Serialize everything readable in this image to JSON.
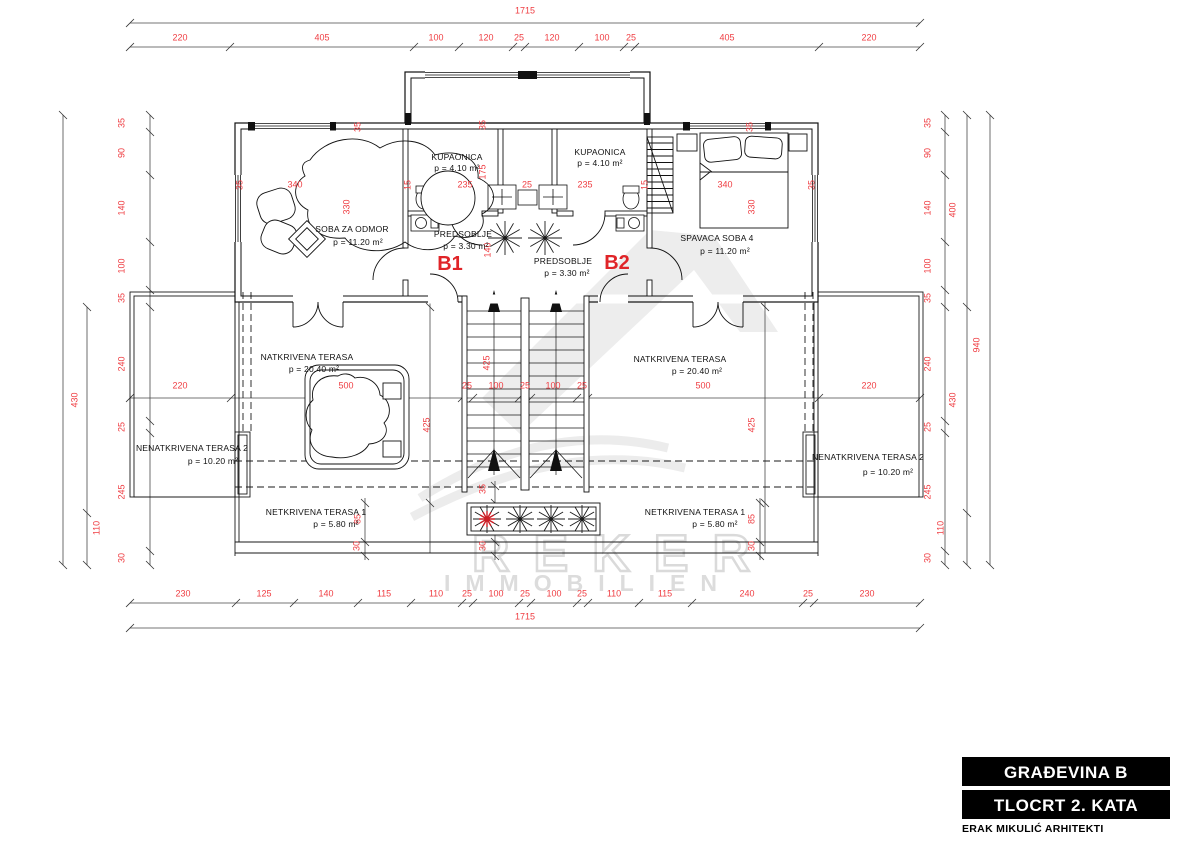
{
  "title_block": {
    "line1": "GRAĐEVINA B",
    "line2": "TLOCRT 2. KATA",
    "line3": "ERAK MIKULIĆ ARHITEKTI"
  },
  "watermark": {
    "word1": "REKER",
    "word2": "IMMOBILIEN"
  },
  "colors": {
    "dimension_red": "#ef3d42",
    "unit_red": "#e02428",
    "line_black": "#1a1a1a",
    "watermark_gray": "#dcdcdc"
  },
  "unit_labels": [
    {
      "t": "B1",
      "x": 450,
      "y": 264
    },
    {
      "t": "B2",
      "x": 617,
      "y": 263
    }
  ],
  "room_labels": [
    {
      "t": "SOBA ZA ODMOR",
      "x": 352,
      "y": 229
    },
    {
      "t": "p = 11.20 m²",
      "x": 358,
      "y": 242
    },
    {
      "t": "KUPAONICA",
      "x": 457,
      "y": 157
    },
    {
      "t": "p = 4.10 m²",
      "x": 457,
      "y": 168
    },
    {
      "t": "KUPAONICA",
      "x": 600,
      "y": 152
    },
    {
      "t": "p = 4.10 m²",
      "x": 600,
      "y": 163
    },
    {
      "t": "PREDSOBLJE",
      "x": 463,
      "y": 234
    },
    {
      "t": "p = 3.30 m²",
      "x": 466,
      "y": 246
    },
    {
      "t": "PREDSOBLJE",
      "x": 563,
      "y": 261
    },
    {
      "t": "p = 3.30 m²",
      "x": 567,
      "y": 273
    },
    {
      "t": "SPAVACA SOBA 4",
      "x": 717,
      "y": 238
    },
    {
      "t": "p = 11.20 m²",
      "x": 725,
      "y": 251
    },
    {
      "t": "NATKRIVENA TERASA",
      "x": 307,
      "y": 357
    },
    {
      "t": "p = 20.40 m²",
      "x": 314,
      "y": 369
    },
    {
      "t": "NATKRIVENA TERASA",
      "x": 680,
      "y": 359
    },
    {
      "t": "p = 20.40 m²",
      "x": 697,
      "y": 371
    },
    {
      "t": "NENATKRIVENA TERASA 2",
      "x": 192,
      "y": 448
    },
    {
      "t": "p = 10.20 m²",
      "x": 213,
      "y": 461
    },
    {
      "t": "NENATKRIVENA TERASA 2",
      "x": 868,
      "y": 457
    },
    {
      "t": "p = 10.20 m²",
      "x": 888,
      "y": 472
    },
    {
      "t": "NETKRIVENA TERASA 1",
      "x": 316,
      "y": 512
    },
    {
      "t": "p = 5.80 m²",
      "x": 336,
      "y": 524
    },
    {
      "t": "NETKRIVENA TERASA 1",
      "x": 695,
      "y": 512
    },
    {
      "t": "p = 5.80 m²",
      "x": 715,
      "y": 524
    }
  ],
  "dimension_labels": [
    {
      "t": "1715",
      "x": 525,
      "y": 11
    },
    {
      "t": "220",
      "x": 180,
      "y": 38
    },
    {
      "t": "405",
      "x": 322,
      "y": 38
    },
    {
      "t": "100",
      "x": 436,
      "y": 38
    },
    {
      "t": "120",
      "x": 486,
      "y": 38
    },
    {
      "t": "25",
      "x": 519,
      "y": 38
    },
    {
      "t": "120",
      "x": 552,
      "y": 38
    },
    {
      "t": "100",
      "x": 602,
      "y": 38
    },
    {
      "t": "25",
      "x": 631,
      "y": 38
    },
    {
      "t": "405",
      "x": 727,
      "y": 38
    },
    {
      "t": "220",
      "x": 869,
      "y": 38
    },
    {
      "t": "230",
      "x": 183,
      "y": 594
    },
    {
      "t": "125",
      "x": 264,
      "y": 594
    },
    {
      "t": "140",
      "x": 326,
      "y": 594
    },
    {
      "t": "115",
      "x": 384,
      "y": 594
    },
    {
      "t": "110",
      "x": 436,
      "y": 594
    },
    {
      "t": "25",
      "x": 467,
      "y": 594
    },
    {
      "t": "100",
      "x": 496,
      "y": 594
    },
    {
      "t": "25",
      "x": 525,
      "y": 594
    },
    {
      "t": "100",
      "x": 554,
      "y": 594
    },
    {
      "t": "25",
      "x": 582,
      "y": 594
    },
    {
      "t": "110",
      "x": 614,
      "y": 594
    },
    {
      "t": "115",
      "x": 665,
      "y": 594
    },
    {
      "t": "240",
      "x": 747,
      "y": 594
    },
    {
      "t": "25",
      "x": 808,
      "y": 594
    },
    {
      "t": "230",
      "x": 867,
      "y": 594
    },
    {
      "t": "1715",
      "x": 525,
      "y": 617
    },
    {
      "t": "35",
      "x": 122,
      "y": 123,
      "r": 1
    },
    {
      "t": "90",
      "x": 122,
      "y": 153,
      "r": 1
    },
    {
      "t": "140",
      "x": 122,
      "y": 208,
      "r": 1
    },
    {
      "t": "100",
      "x": 122,
      "y": 266,
      "r": 1
    },
    {
      "t": "35",
      "x": 122,
      "y": 298,
      "r": 1
    },
    {
      "t": "240",
      "x": 122,
      "y": 364,
      "r": 1
    },
    {
      "t": "25",
      "x": 122,
      "y": 427,
      "r": 1
    },
    {
      "t": "245",
      "x": 122,
      "y": 492,
      "r": 1
    },
    {
      "t": "30",
      "x": 122,
      "y": 558,
      "r": 1
    },
    {
      "t": "430",
      "x": 75,
      "y": 400,
      "r": 1
    },
    {
      "t": "110",
      "x": 97,
      "y": 528,
      "r": 1
    },
    {
      "t": "35",
      "x": 928,
      "y": 123,
      "r": 1
    },
    {
      "t": "90",
      "x": 928,
      "y": 153,
      "r": 1
    },
    {
      "t": "140",
      "x": 928,
      "y": 208,
      "r": 1
    },
    {
      "t": "100",
      "x": 928,
      "y": 266,
      "r": 1
    },
    {
      "t": "35",
      "x": 928,
      "y": 298,
      "r": 1
    },
    {
      "t": "240",
      "x": 928,
      "y": 364,
      "r": 1
    },
    {
      "t": "25",
      "x": 928,
      "y": 427,
      "r": 1
    },
    {
      "t": "245",
      "x": 928,
      "y": 492,
      "r": 1
    },
    {
      "t": "30",
      "x": 928,
      "y": 558,
      "r": 1
    },
    {
      "t": "400",
      "x": 953,
      "y": 210,
      "r": 1
    },
    {
      "t": "430",
      "x": 953,
      "y": 400,
      "r": 1
    },
    {
      "t": "110",
      "x": 941,
      "y": 528,
      "r": 1
    },
    {
      "t": "940",
      "x": 977,
      "y": 345,
      "r": 1
    },
    {
      "t": "220",
      "x": 180,
      "y": 386
    },
    {
      "t": "500",
      "x": 346,
      "y": 386
    },
    {
      "t": "25",
      "x": 467,
      "y": 386
    },
    {
      "t": "100",
      "x": 496,
      "y": 386
    },
    {
      "t": "25",
      "x": 525,
      "y": 386
    },
    {
      "t": "100",
      "x": 553,
      "y": 386
    },
    {
      "t": "25",
      "x": 582,
      "y": 386
    },
    {
      "t": "500",
      "x": 703,
      "y": 386
    },
    {
      "t": "220",
      "x": 869,
      "y": 386
    },
    {
      "t": "35",
      "x": 240,
      "y": 185,
      "r": 1
    },
    {
      "t": "340",
      "x": 295,
      "y": 185
    },
    {
      "t": "15",
      "x": 408,
      "y": 185,
      "r": 1
    },
    {
      "t": "235",
      "x": 465,
      "y": 185
    },
    {
      "t": "25",
      "x": 527,
      "y": 185
    },
    {
      "t": "235",
      "x": 585,
      "y": 185
    },
    {
      "t": "15",
      "x": 645,
      "y": 185,
      "r": 1
    },
    {
      "t": "340",
      "x": 725,
      "y": 185
    },
    {
      "t": "35",
      "x": 812,
      "y": 185,
      "r": 1
    },
    {
      "t": "330",
      "x": 347,
      "y": 207,
      "r": 1
    },
    {
      "t": "330",
      "x": 752,
      "y": 207,
      "r": 1
    },
    {
      "t": "175",
      "x": 483,
      "y": 172,
      "r": 1
    },
    {
      "t": "140",
      "x": 488,
      "y": 250,
      "r": 1
    },
    {
      "t": "35",
      "x": 358,
      "y": 127,
      "r": 1
    },
    {
      "t": "35",
      "x": 483,
      "y": 125,
      "r": 1
    },
    {
      "t": "35",
      "x": 750,
      "y": 127,
      "r": 1
    },
    {
      "t": "425",
      "x": 487,
      "y": 363,
      "r": 1
    },
    {
      "t": "425",
      "x": 427,
      "y": 425,
      "r": 1
    },
    {
      "t": "425",
      "x": 752,
      "y": 425,
      "r": 1
    },
    {
      "t": "85",
      "x": 358,
      "y": 519,
      "r": 1
    },
    {
      "t": "30",
      "x": 357,
      "y": 546,
      "r": 1
    },
    {
      "t": "35",
      "x": 483,
      "y": 489,
      "r": 1
    },
    {
      "t": "30",
      "x": 483,
      "y": 546,
      "r": 1
    },
    {
      "t": "85",
      "x": 752,
      "y": 519,
      "r": 1
    },
    {
      "t": "30",
      "x": 752,
      "y": 546,
      "r": 1
    }
  ]
}
